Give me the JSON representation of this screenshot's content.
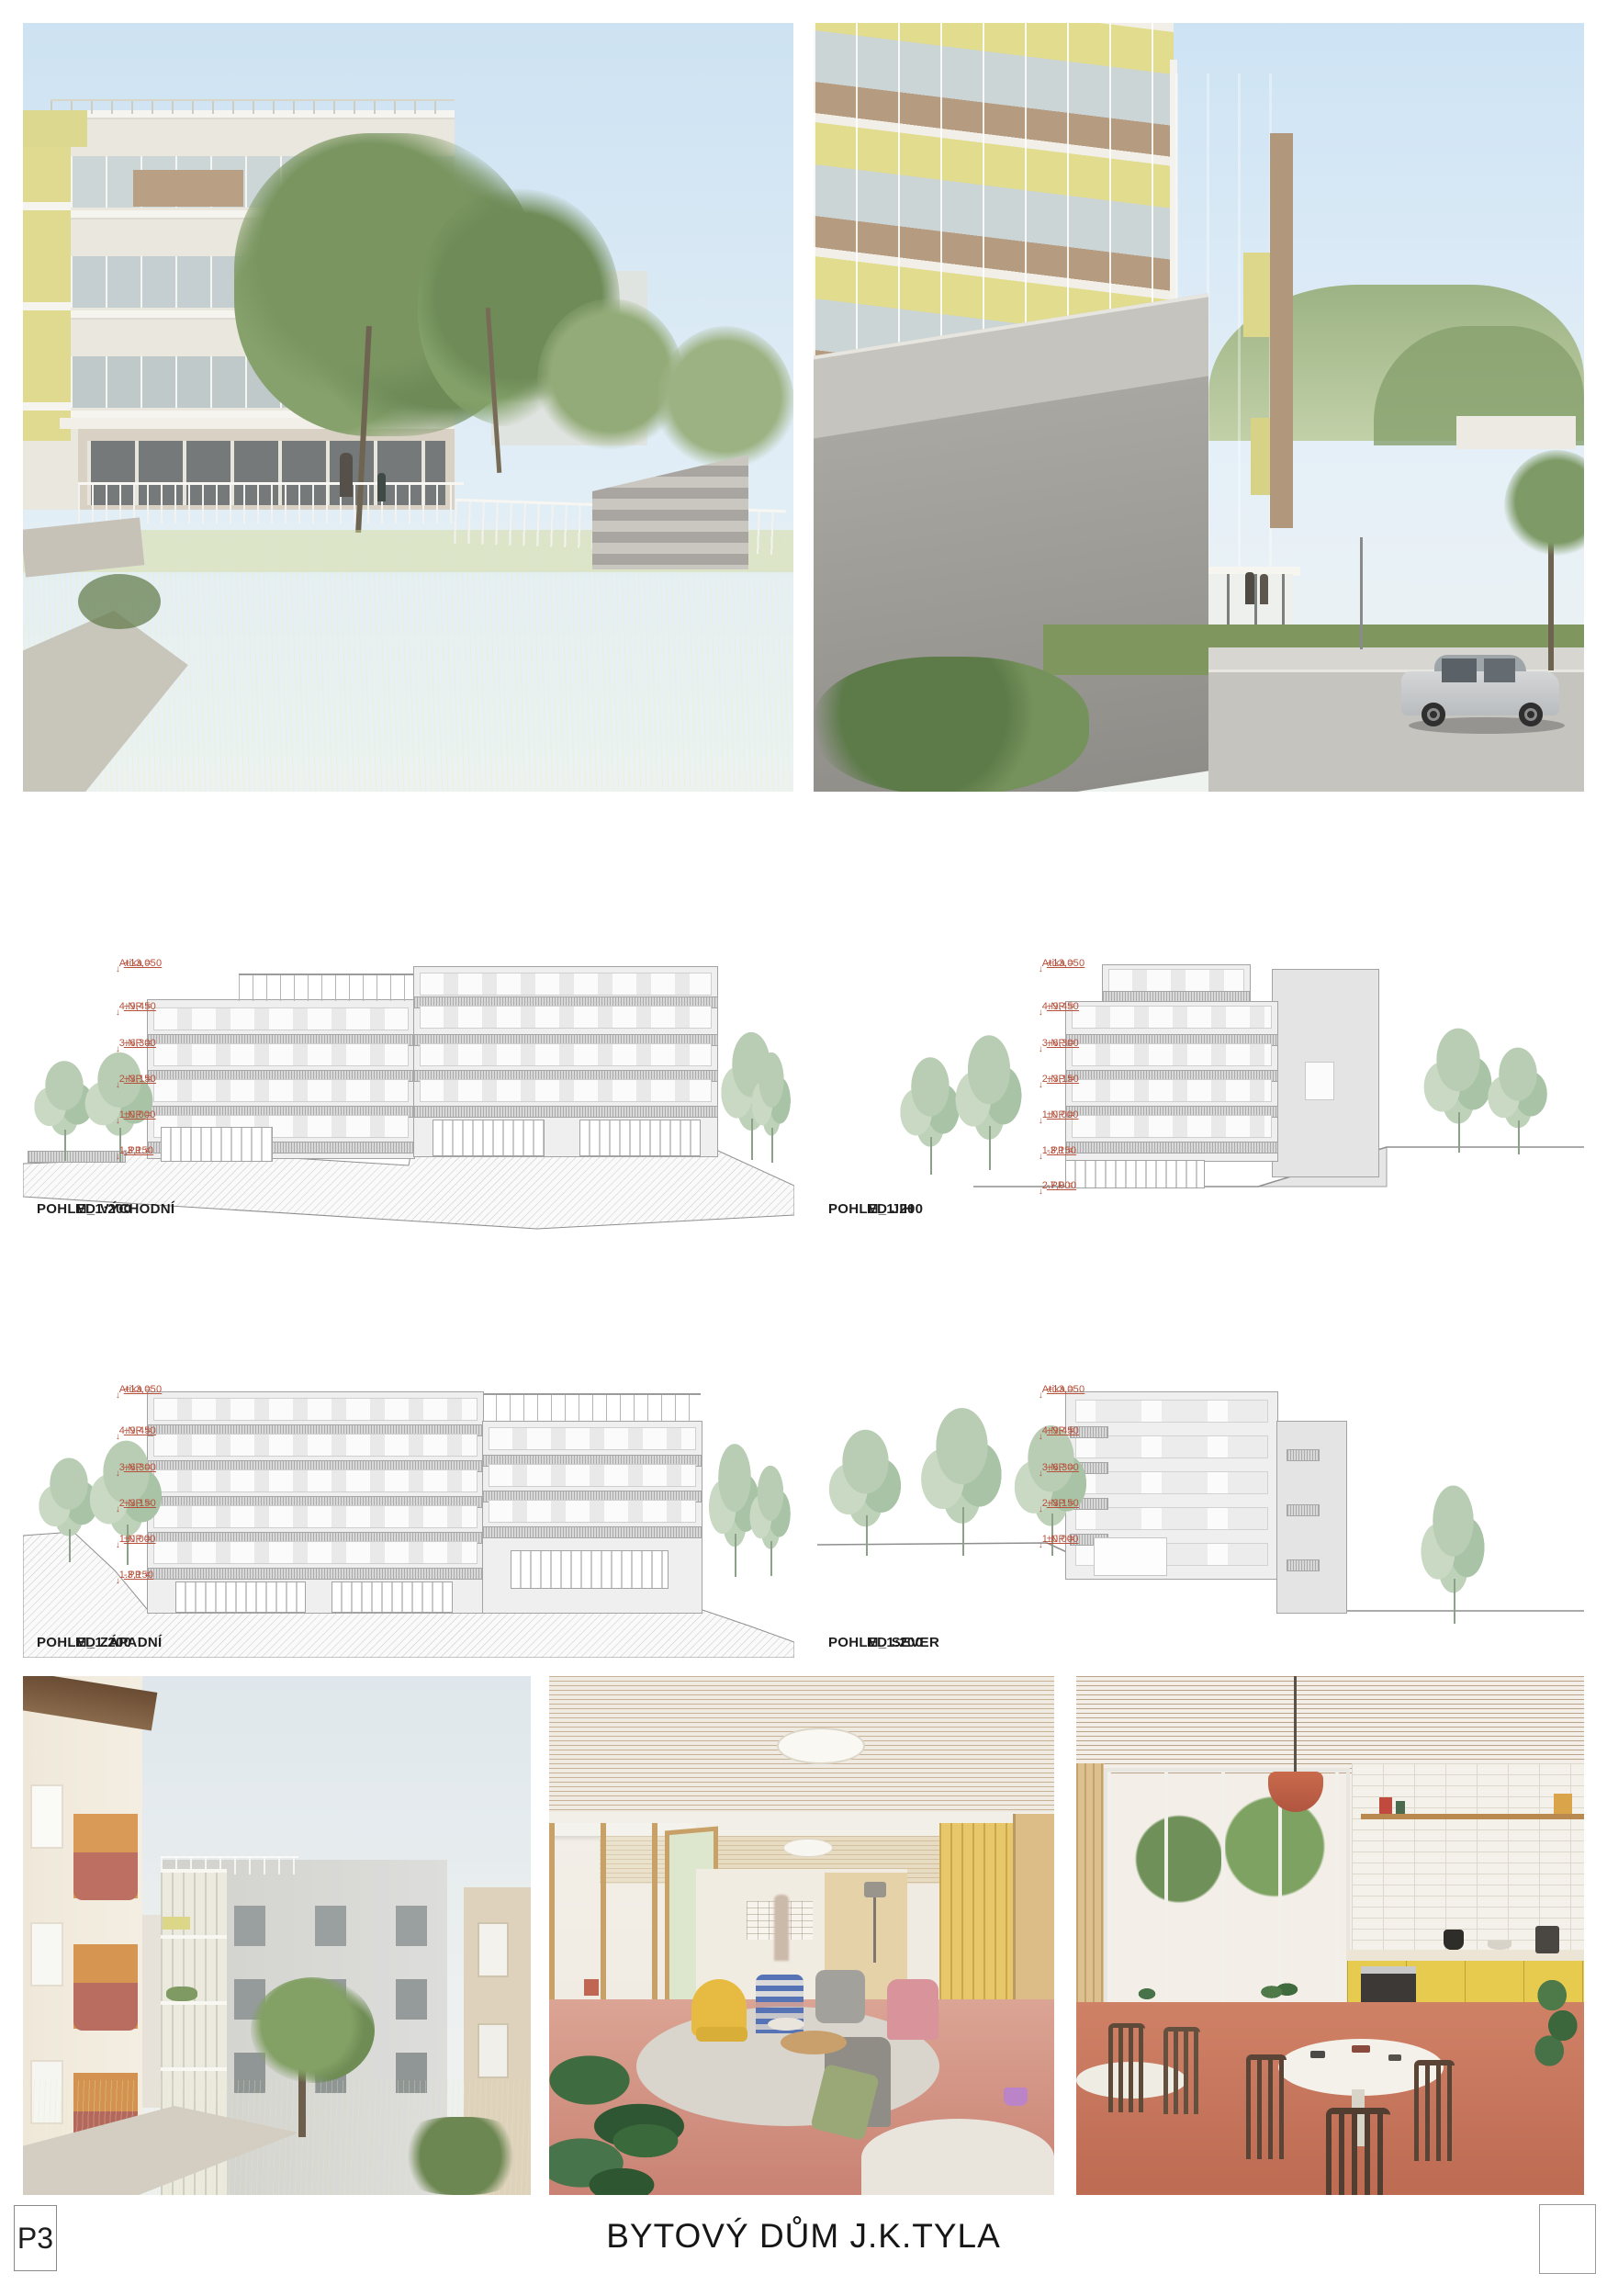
{
  "board": {
    "sheet_number": "P3",
    "title": "BYTOVÝ DŮM J.K.TYLA"
  },
  "colors": {
    "annotation_red": "#b5503b",
    "facade_yellow": "#e3dd95",
    "sky_blue": "#cfe3f2",
    "floor_terracotta": "#cc8a7c",
    "kitchen_yellow": "#e6cb4f"
  },
  "elevations": [
    {
      "label": "POHLED VÝCHODNÍ",
      "scale": "M_1:200",
      "levels": [
        {
          "name": "Atika =",
          "value": "+13,050"
        },
        {
          "name": "4.NP =",
          "value": "+9,450"
        },
        {
          "name": "3.NP =",
          "value": "+6,300"
        },
        {
          "name": "2.NP =",
          "value": "+3,150"
        },
        {
          "name": "1.NP =",
          "value": "±0,000"
        },
        {
          "name": "1.PP =",
          "value": "-3,150"
        }
      ]
    },
    {
      "label": "POHLED JIH",
      "scale": "M_1:200",
      "levels": [
        {
          "name": "Atika =",
          "value": "+13,050"
        },
        {
          "name": "4.NP =",
          "value": "+9,450"
        },
        {
          "name": "3.NP =",
          "value": "+6,300"
        },
        {
          "name": "2.NP =",
          "value": "+3,150"
        },
        {
          "name": "1.NP =",
          "value": "±0,000"
        },
        {
          "name": "1.PP =",
          "value": "-3,150"
        },
        {
          "name": "2.PP =",
          "value": "-7,000"
        }
      ]
    },
    {
      "label": "POHLED ZÁPADNÍ",
      "scale": "M_1:200",
      "levels": [
        {
          "name": "Atika =",
          "value": "+13,050"
        },
        {
          "name": "4.NP =",
          "value": "+9,450"
        },
        {
          "name": "3.NP =",
          "value": "+6,300"
        },
        {
          "name": "2.NP =",
          "value": "+3,150"
        },
        {
          "name": "1.NP =",
          "value": "±0,000"
        },
        {
          "name": "1.PP =",
          "value": "-3,150"
        }
      ]
    },
    {
      "label": "POHLED SEVER",
      "scale": "M_1:200",
      "levels": [
        {
          "name": "Atika =",
          "value": "+13,050"
        },
        {
          "name": "4.NP =",
          "value": "+9,450"
        },
        {
          "name": "3.NP =",
          "value": "+6,300"
        },
        {
          "name": "2.NP =",
          "value": "+3,150"
        },
        {
          "name": "1.NP =",
          "value": "±0,000"
        }
      ]
    }
  ]
}
